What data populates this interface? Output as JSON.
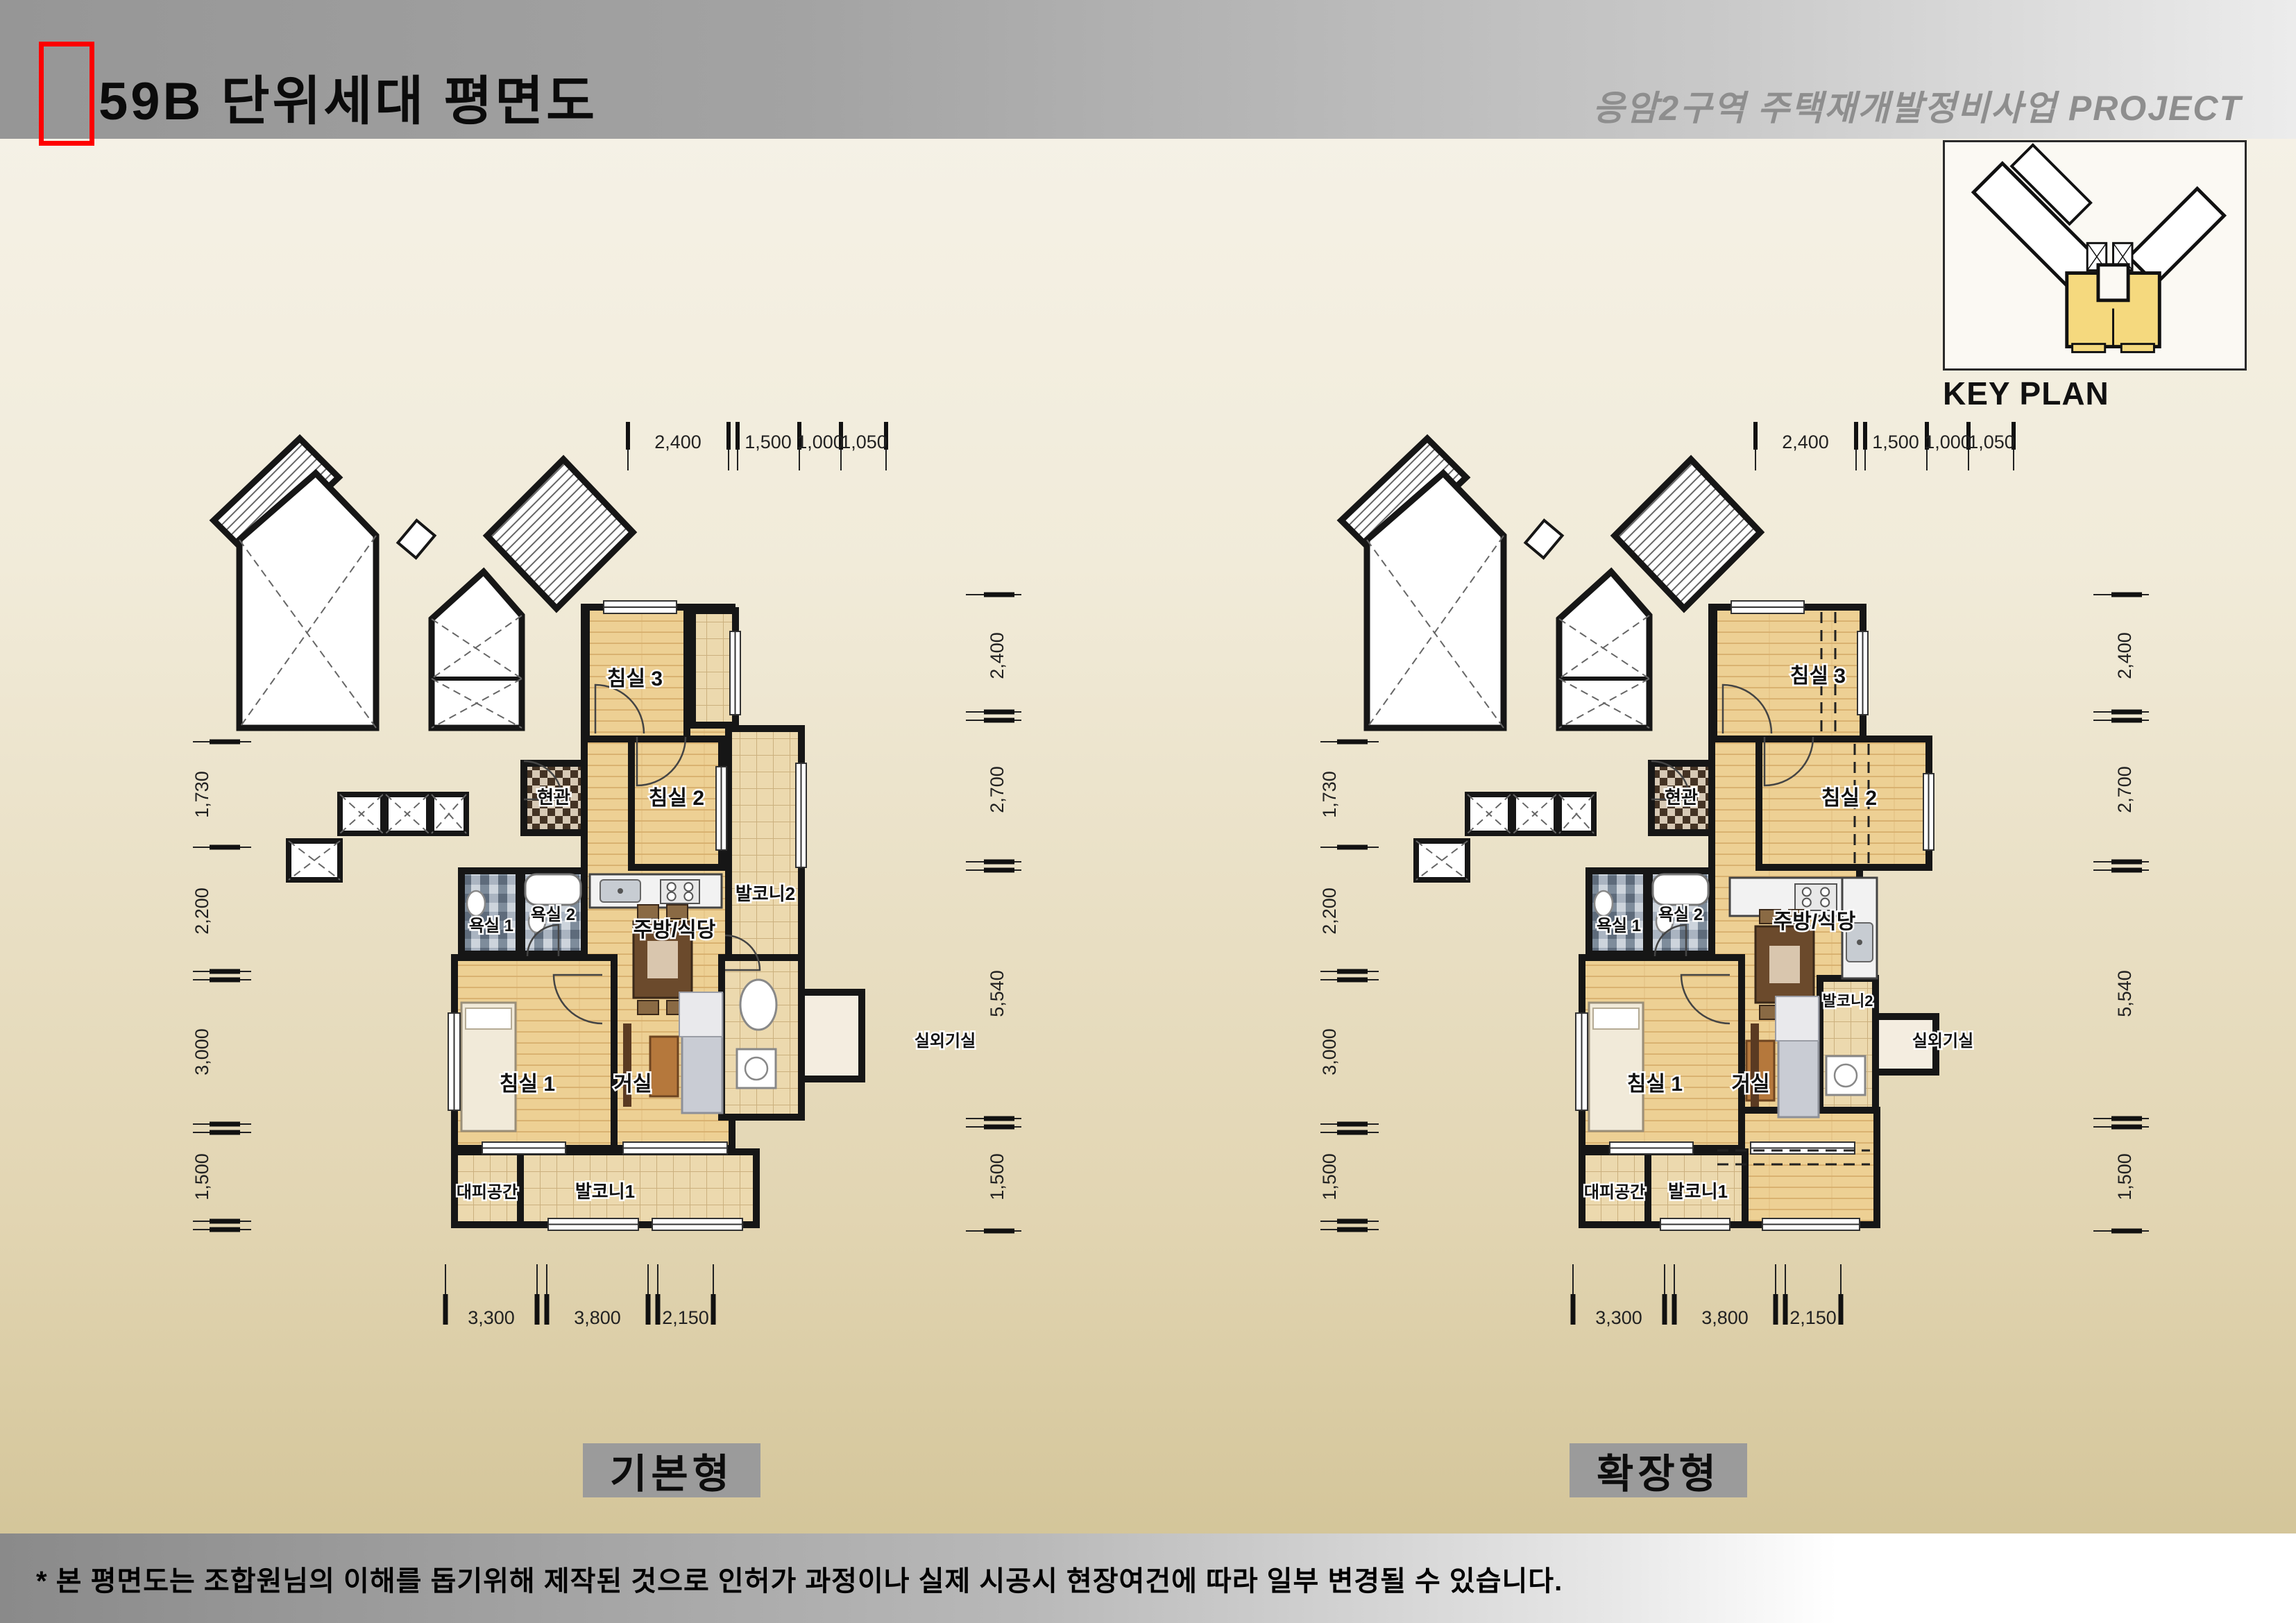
{
  "header": {
    "title": "59B 단위세대 평면도",
    "project": "응암2구역  주택재개발정비사업 PROJECT"
  },
  "key_plan": {
    "label": "KEY PLAN"
  },
  "footnote": "* 본 평면도는 조합원님의 이해를 돕기위해 제작된 것으로 인허가 과정이나 실제 시공시 현장여건에 따라 일부 변경될 수 있습니다.",
  "colors": {
    "accent_red": "#fe0000",
    "wall": "#161616",
    "wood": "#edd094",
    "tile": "#ecd9ae",
    "keyplan_highlight": "#f5d97e",
    "plate_gray": "#9b9b9b"
  },
  "plans": [
    {
      "id": "basic",
      "label": "기본형",
      "rooms": {
        "bedroom3": "침실 3",
        "bedroom2": "침실 2",
        "bedroom1": "침실 1",
        "entrance": "현관",
        "bath1": "욕실 1",
        "bath2": "욕실 2",
        "kitchen": "주방/식당",
        "living": "거실",
        "balcony1": "발코니1",
        "balcony2": "발코니2",
        "refuge": "대피공간",
        "ac_room": "실외기실"
      },
      "dims": {
        "top": [
          "2,400",
          "1,500",
          "1,000",
          "1,050"
        ],
        "right": [
          "2,400",
          "2,700",
          "5,540",
          "1,500"
        ],
        "left": [
          "1,730",
          "2,200",
          "3,000",
          "1,500"
        ],
        "bottom": [
          "3,300",
          "3,800",
          "2,150"
        ]
      }
    },
    {
      "id": "extended",
      "label": "확장형",
      "rooms": {
        "bedroom3": "침실 3",
        "bedroom2": "침실 2",
        "bedroom1": "침실 1",
        "entrance": "현관",
        "bath1": "욕실 1",
        "bath2": "욕실 2",
        "kitchen": "주방/식당",
        "living": "거실",
        "balcony1": "발코니1",
        "balcony2": "발코니2",
        "refuge": "대피공간",
        "ac_room": "실외기실"
      },
      "dims": {
        "top": [
          "2,400",
          "1,500",
          "1,000",
          "1,050"
        ],
        "right": [
          "2,400",
          "2,700",
          "5,540",
          "1,500"
        ],
        "left": [
          "1,730",
          "2,200",
          "3,000",
          "1,500"
        ],
        "bottom": [
          "3,300",
          "3,800",
          "2,150"
        ]
      }
    }
  ]
}
